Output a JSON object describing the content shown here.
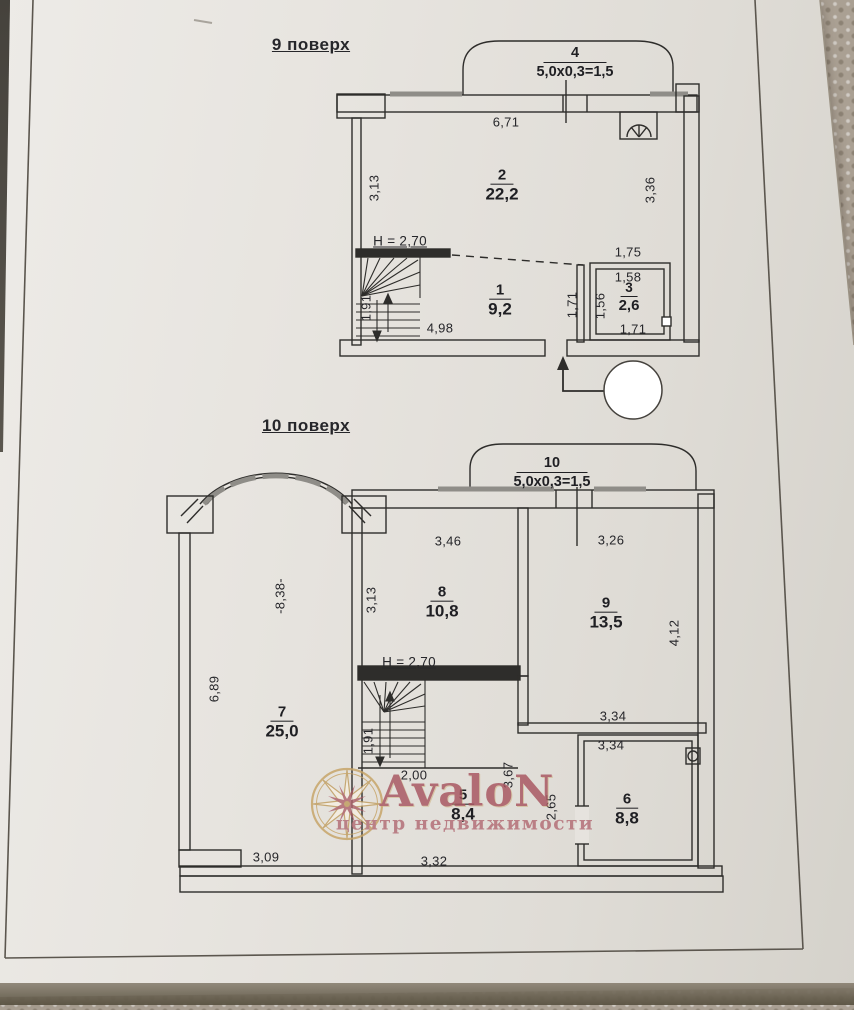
{
  "watermark": {
    "brand": "AvaloN",
    "tagline": "центр недвижимости",
    "gold": "#c6a365",
    "red": "#a7545f"
  },
  "floor9": {
    "title": "9 поверх",
    "balcony": {
      "num": "4",
      "size": "5,0x0,3=1,5"
    },
    "rooms": {
      "r2": {
        "num": "2",
        "area": "22,2"
      },
      "r1": {
        "num": "1",
        "area": "9,2"
      },
      "r3": {
        "num": "3",
        "area": "2,6"
      }
    },
    "dims": {
      "top": "6,71",
      "left": "3,13",
      "right": "3,36",
      "height": "H = 2,70",
      "hall_w": "1,75",
      "wc_top": "1,58",
      "wc_left": "1,56",
      "wc_bottom": "1,71",
      "corridor": "1,71",
      "room1_w": "4,98",
      "stairs": "1,91"
    }
  },
  "floor10": {
    "title": "10 поверх",
    "balcony": {
      "num": "10",
      "size": "5,0x0,3=1,5"
    },
    "rooms": {
      "r8": {
        "num": "8",
        "area": "10,8"
      },
      "r9": {
        "num": "9",
        "area": "13,5"
      },
      "r7": {
        "num": "7",
        "area": "25,0"
      },
      "r5": {
        "num": "5",
        "area": "8,4"
      },
      "r6": {
        "num": "6",
        "area": "8,8"
      }
    },
    "dims": {
      "room8_top": "3,46",
      "room9_top": "3,26",
      "bay": "-8,38-",
      "room8_left": "3,13",
      "room9_right": "4,12",
      "room7_left": "6,89",
      "height": "H = 2,70",
      "stairs": "1,91",
      "stairs_bottom": "2,00",
      "corridor_h": "3,67",
      "hall_w": "3,34",
      "room6_top": "3,34",
      "room6_left": "2,65",
      "room7_bottom": "3,09",
      "room5_bottom": "3,32"
    }
  }
}
